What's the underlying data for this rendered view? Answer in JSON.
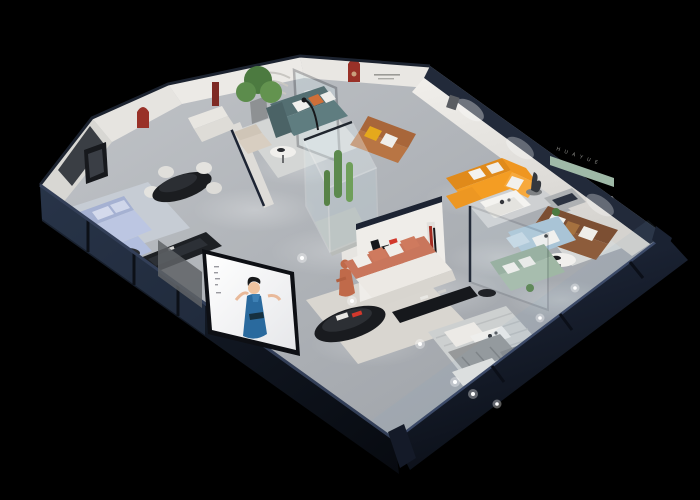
{
  "scene": {
    "type": "3d-isometric-showroom-cutaway-render",
    "background_color": "#000000",
    "floor_color": "#b2b5ba",
    "wall_color": "#e9e7e3",
    "trim_color": "#1d2433",
    "arch_niche_color": "#993128"
  },
  "brand": {
    "logo_letter": "H",
    "logo_black": "#17181c",
    "logo_red": "#d2382c",
    "logo_name_cn": "华悦",
    "right_wall_letters": "H U A Y U E"
  },
  "display_screen": {
    "subject": "woman presenter in blue dress",
    "background": "#f4f4f6",
    "dress_color": "#2a6a9e"
  },
  "furniture": [
    {
      "name": "periwinkle-sectional-sofa",
      "color": "#b9c4e0"
    },
    {
      "name": "black-oval-dining-table",
      "color": "#1b1d20"
    },
    {
      "name": "white-dining-chairs",
      "color": "#e4e3df"
    },
    {
      "name": "teal-sofa",
      "color": "#5f7d80"
    },
    {
      "name": "potted-tree",
      "color": "#4c7a40"
    },
    {
      "name": "beige-armchair",
      "color": "#d8cec1"
    },
    {
      "name": "caramel-leather-sofa",
      "color": "#b87544"
    },
    {
      "name": "orange-l-sectional-sofa",
      "color": "#f49d23"
    },
    {
      "name": "white-coffee-table",
      "color": "#f4f3f0"
    },
    {
      "name": "bronze-statue",
      "color": "#34383e"
    },
    {
      "name": "brown-leather-sofa",
      "color": "#8d5c3b"
    },
    {
      "name": "green-wall-shelf",
      "color": "#9fb9a7"
    },
    {
      "name": "salmon-sofa",
      "color": "#cf7a5e"
    },
    {
      "name": "black-oval-coffee-table",
      "color": "#191b1f"
    },
    {
      "name": "light-blue-daybed",
      "color": "#a9c4d6"
    },
    {
      "name": "sage-green-sofa",
      "color": "#9fb7a4"
    },
    {
      "name": "terracotta-mannequin",
      "color": "#bf6a4a"
    },
    {
      "name": "glass-plant-display-case",
      "color": "#d8ecf2"
    }
  ]
}
